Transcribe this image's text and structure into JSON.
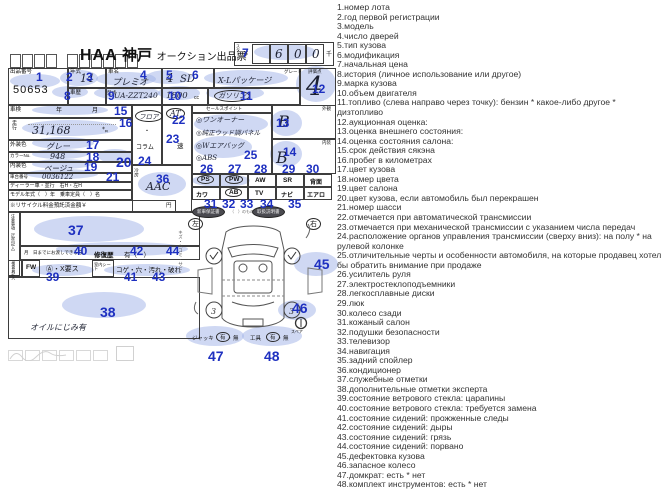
{
  "legend": {
    "items": [
      "1.номер лота",
      "2.год первой регистрации",
      "3.модель",
      "4.число дверей",
      "5.тип кузова",
      "6.модификация",
      "7.начальная цена",
      "8.история (личное использование или другое)",
      "9.марка кузова",
      "10.объем двигателя",
      "11.топливо (слева направо через точку): бензин * какое-либо другое * дизтопливо",
      "12.аукционная оценка:",
      "13.оценка внешнего состояния:",
      "14.оценка состояния салона:",
      "15.срок действия сякэна",
      "16.пробег в километрах",
      "17.цвет кузова",
      "18.номер цвета",
      "19.цвет салона",
      "20.цвет кузова, если автомобиль был перекрашен",
      "21.номер шасси",
      "22.отмечается при автоматической трансмиссии",
      "23.отмечается при механической трансмиссии с указанием числа передач",
      "24.расположение органов управления трансмиссии (сверху вниз): на полу * на рулевой колонке",
      "25.отличительные черты и особенности автомобиля, на которые продавец хотел бы обратить внимание при продаже",
      "26.усилитель руля",
      "27.электростеклоподъемники",
      "28.легкосплавные диски",
      "29.люк",
      "30.колесо сзади",
      "31.кожаный салон",
      "32.подушки безопасности",
      "33.телевизор",
      "34.навигация",
      "35.задний спойлер",
      "36.кондиционер",
      "37.служебные отметки",
      "38.дополнительные отметки эксперта",
      "39.состояние ветрового стекла: царапины",
      "40.состояние ветрового стекла: требуется замена",
      "41.состояние сидений: прожженные следы",
      "42.состояние сидений: дыры",
      "43.состояние сидений: грязь",
      "44.состояние сидений: порвано",
      "45.дефектовка кузова",
      "46.запасное колесо",
      "47.домкрат: есть * нет",
      "48.комплект инструментов: есть * нет"
    ]
  },
  "ann": [
    "1",
    "2",
    "3",
    "4",
    "5",
    "6",
    "7",
    "8",
    "9",
    "10",
    "11",
    "12",
    "13",
    "14",
    "15",
    "16",
    "17",
    "18",
    "19",
    "20",
    "21",
    "22",
    "23",
    "24",
    "25",
    "26",
    "27",
    "28",
    "29",
    "30",
    "31",
    "32",
    "33",
    "34",
    "35",
    "36",
    "37",
    "38",
    "39",
    "40",
    "41",
    "42",
    "43",
    "44",
    "45",
    "46",
    "47",
    "48"
  ],
  "sheet": {
    "title": {
      "haa": "HAA",
      "kobe": "神戸",
      "rest": "オークション出品票"
    },
    "start": {
      "label": "スタート",
      "yen": "¥",
      "d1": "6",
      "d2": "0",
      "d3": "0",
      "unit": "千"
    },
    "lot": {
      "label": "出品番号",
      "value": "50653"
    },
    "year": {
      "label": "年式",
      "value": "14"
    },
    "name": {
      "label": "車名",
      "value": "プレミオ"
    },
    "doors": {
      "value": "4"
    },
    "body": {
      "value": "SD"
    },
    "grade": {
      "label": "グレード",
      "value": "X-Lパッケージ"
    },
    "score": {
      "label": "評価点",
      "value": "4"
    },
    "hist": {
      "label": "車歴"
    },
    "code": {
      "label": "型式",
      "value": "UA-ZZT240"
    },
    "disp": {
      "value": "1800",
      "unit": "cc"
    },
    "fuel": {
      "value": "ガソリン"
    },
    "shaken": {
      "label": "車検",
      "year": "年",
      "month": "月"
    },
    "mileage": {
      "label": "走行",
      "value": "31,168",
      "unit": "㌔"
    },
    "ext_color": {
      "label": "外装色",
      "value": "グレー"
    },
    "color_no": {
      "label": "カラーNo.",
      "value": "948"
    },
    "int_color": {
      "label": "内装色",
      "value": "ベージュ"
    },
    "chassis": {
      "label": "車台番号",
      "value": "0036122"
    },
    "dealer_row": "ディーラー車・並行　右H・左H",
    "model_row": "モデル年式（　）年　乗車定員（　）名",
    "recycle_row": "※リサイクル料金預託済金額￥",
    "yen_suffix": "円",
    "shift": {
      "floor": "フロア",
      "dot": "・",
      "column": "コラム"
    },
    "trans": {
      "at": "AT",
      "speed": "速"
    },
    "ac": {
      "label": "冷房",
      "value": "AAC"
    },
    "sales": {
      "header": "セールスポイント",
      "p1": "◎ワンオーナー",
      "p2": "◎純正ウッド調パネル",
      "p3": "◎Wエアバッグ",
      "p4": "◎ABS"
    },
    "ext_score": {
      "label": "外観",
      "value": "B"
    },
    "int_score": {
      "label": "内装",
      "value": "B"
    },
    "equip1": [
      "PS",
      "PW",
      "AW",
      "SR",
      "背面"
    ],
    "equip2": [
      "カワ",
      "AB",
      "TV",
      "ナビ",
      "エアロ"
    ],
    "docs": {
      "warranty": "新車保証書",
      "middle": "（　）のもの",
      "manual": "取扱説明書"
    },
    "notes_label": "注意事項（広告記入）",
    "repair": {
      "pre": "月　日までにお渡しできる方",
      "label": "修復歴",
      "value": "有（　）"
    },
    "inspector": {
      "label": "検査員記入",
      "fw": "FW",
      "fw_opts": "Ⓐ・X要ス",
      "seat": "室内シート",
      "seat_opts": "コゲ・穴・汚れ・破れ"
    },
    "oil_note": "オイルにじみ有",
    "diagram": {
      "left": "左",
      "right": "右",
      "scratch": "キズ・ヘコミ・サビ",
      "jack": "ジャッキ",
      "tools": "工具",
      "yes": "有",
      "sep": "・",
      "no": "無",
      "spare": "スペア",
      "w3": "3"
    }
  }
}
